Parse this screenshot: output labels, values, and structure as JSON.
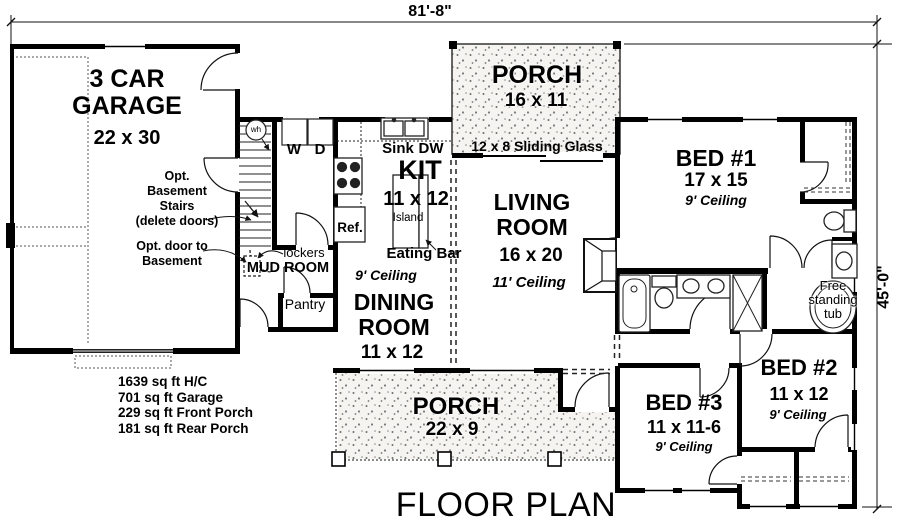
{
  "title": "FLOOR PLAN",
  "dimensions": {
    "width": "81'-8\"",
    "height": "45'-0\""
  },
  "rooms": {
    "garage": {
      "name": "3 CAR GARAGE",
      "size": "22 x 30"
    },
    "rear_porch": {
      "name": "PORCH",
      "size": "16 x 11"
    },
    "kitchen": {
      "name": "KIT",
      "size": "11 x 12"
    },
    "living": {
      "name": "LIVING ROOM",
      "size": "16 x 20",
      "ceiling": "11' Ceiling"
    },
    "dining": {
      "name": "DINING ROOM",
      "size": "11 x 12",
      "ceiling": "9' Ceiling"
    },
    "mud": {
      "name": "MUD ROOM"
    },
    "pantry": {
      "name": "Pantry"
    },
    "bed1": {
      "name": "BED #1",
      "size": "17 x 15",
      "ceiling": "9' Ceiling"
    },
    "bed2": {
      "name": "BED #2",
      "size": "11 x 12",
      "ceiling": "9' Ceiling"
    },
    "bed3": {
      "name": "BED #3",
      "size": "11 x 11-6",
      "ceiling": "9' Ceiling"
    },
    "front_porch": {
      "name": "PORCH",
      "size": "22 x 9"
    }
  },
  "fixtures": {
    "sink": "Sink",
    "dishwasher": "DW",
    "refrigerator": "Ref.",
    "island": "Island",
    "eating_bar": "Eating Bar",
    "washer": "W",
    "dryer": "D",
    "water_heater": "wh",
    "lockers": "lockers",
    "sliding_glass": "12 x 8 Sliding Glass",
    "free_standing_tub": "Free\nstanding\ntub"
  },
  "notes": {
    "opt_stairs": "Opt.\nBasement\nStairs\n(delete doors)",
    "opt_basement_door": "Opt. door to\nBasement"
  },
  "areas": [
    "1639 sq ft H/C",
    "701 sq ft Garage",
    "229 sq ft Front Porch",
    "181 sq ft Rear Porch"
  ]
}
